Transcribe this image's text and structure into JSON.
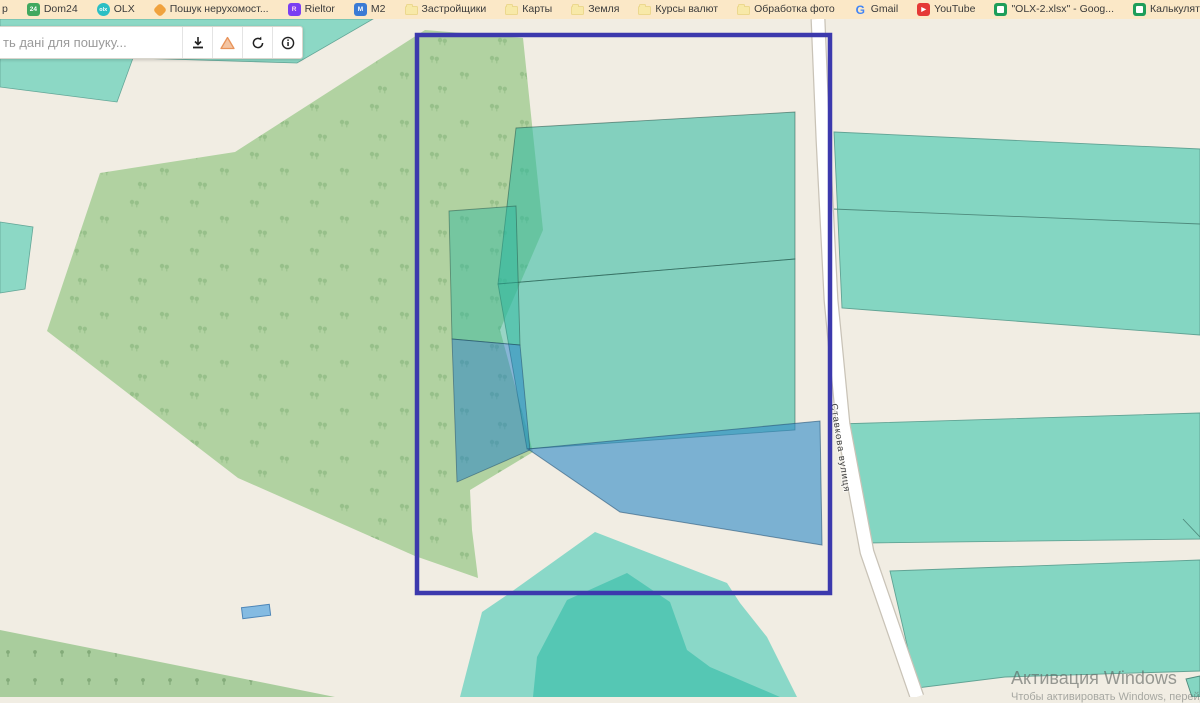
{
  "bookmarks_bar": {
    "items": [
      {
        "label": "p",
        "icon": "none"
      },
      {
        "label": "Dom24",
        "icon": "dom24-icon",
        "icon_text": "24",
        "color": "#41a85f"
      },
      {
        "label": "OLX",
        "icon": "olx-icon",
        "icon_text": "olx",
        "color": "#2bbfc4"
      },
      {
        "label": "Пошук нерухомост...",
        "icon": "search-realty-icon",
        "color": "#f0a23e"
      },
      {
        "label": "Rieltor",
        "icon": "rieltor-icon",
        "icon_text": "R",
        "color": "#7a3ff2"
      },
      {
        "label": "M2",
        "icon": "m2-icon",
        "icon_text": "M",
        "color": "#3b7bd4"
      },
      {
        "label": "Застройщики",
        "icon": "folder-icon",
        "color": "#f8e9a8"
      },
      {
        "label": "Карты",
        "icon": "folder-icon",
        "color": "#f8e9a8"
      },
      {
        "label": "Земля",
        "icon": "folder-icon",
        "color": "#f8e9a8"
      },
      {
        "label": "Курсы валют",
        "icon": "folder-icon",
        "color": "#f8e9a8"
      },
      {
        "label": "Обработка фото",
        "icon": "folder-icon",
        "color": "#f8e9a8"
      },
      {
        "label": "Gmail",
        "icon": "google-icon",
        "icon_text": "G",
        "color": "#4285f4"
      },
      {
        "label": "YouTube",
        "icon": "youtube-icon",
        "icon_text": "▶",
        "color": "#e53935"
      },
      {
        "label": "\"OLX-2.xlsx\" - Goog...",
        "icon": "sheets-icon",
        "color": "#1e9e5a"
      },
      {
        "label": "Калькулятор - Goo...",
        "icon": "sheets-icon",
        "color": "#1e9e5a"
      },
      {
        "label": "DeepL Translate – C...",
        "icon": "deepl-icon",
        "icon_text": "▼",
        "color": "#12304e"
      }
    ]
  },
  "search_panel": {
    "placeholder": "ть дані для пошуку...",
    "buttons": [
      {
        "name": "download"
      },
      {
        "name": "warning"
      },
      {
        "name": "refresh"
      },
      {
        "name": "info"
      }
    ]
  },
  "map": {
    "street_label": "Ставкова вулиця",
    "colors": {
      "background": "#f1ede3",
      "selection_rect": "#3c39ad",
      "parcel_teal": "#84d6c2",
      "parcel_blue": "#7bb1d2",
      "forest": "#b1d2a1",
      "pond_outer": "#8ad8c8",
      "pond_inner": "#55c7b4",
      "road": "#ffffff"
    }
  },
  "watermark": {
    "line1": "Активация Windows",
    "line2": "Чтобы активировать Windows, перейдите в раздел"
  }
}
